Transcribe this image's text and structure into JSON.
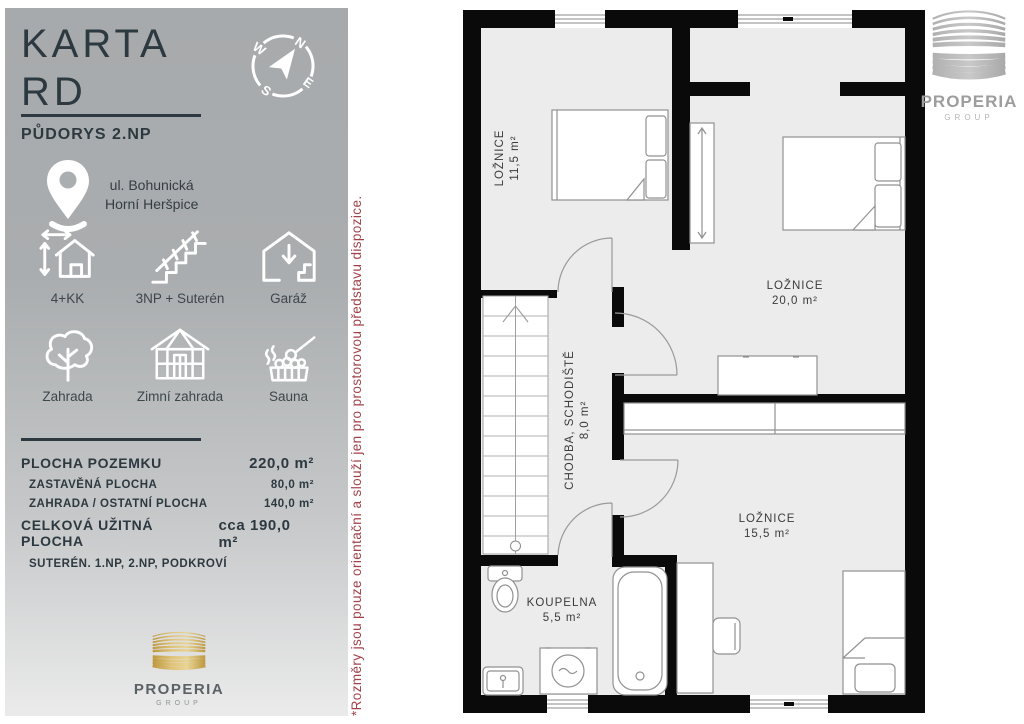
{
  "colors": {
    "accent_red": "#a1424a",
    "gold": "#c9a64e",
    "panel_text": "#2d3940",
    "wall": "#0a0a0a",
    "room_fill": "#ececec"
  },
  "panel": {
    "title_line1": "KARTA",
    "title_line2": "RD",
    "subtitle": "PŮDORYS 2.NP",
    "address_line1": "ul. Bohunická",
    "address_line2": "Horní Heršpice",
    "features": [
      {
        "icon": "house-dimensions-icon",
        "label": "4+KK"
      },
      {
        "icon": "stairs-icon",
        "label": "3NP + Suterén"
      },
      {
        "icon": "garage-icon",
        "label": "Garáž"
      },
      {
        "icon": "tree-icon",
        "label": "Zahrada"
      },
      {
        "icon": "greenhouse-icon",
        "label": "Zimní zahrada"
      },
      {
        "icon": "sauna-icon",
        "label": "Sauna"
      }
    ],
    "areas": [
      {
        "label": "PLOCHA POZEMKU",
        "value": "220,0 m²"
      },
      {
        "label": "ZASTAVĚNÁ PLOCHA",
        "value": "80,0 m²"
      },
      {
        "label": "ZAHRADA / OSTATNÍ PLOCHA",
        "value": "140,0 m²"
      },
      {
        "label": "CELKOVÁ UŽITNÁ PLOCHA",
        "value": "cca 190,0 m²"
      },
      {
        "label": "SUTERÉN. 1.NP, 2.NP, PODKROVÍ",
        "value": ""
      }
    ],
    "logo": {
      "name": "PROPERIA",
      "sub": "GROUP"
    }
  },
  "compass": {
    "n": "N",
    "e": "E",
    "s": "S",
    "w": "W"
  },
  "disclaimer": "*Rozměry jsou pouze orientační a slouží jen pro prostorovou představu dispozice.",
  "plan": {
    "logo": {
      "name": "PROPERIA",
      "sub": "GROUP"
    },
    "rooms": [
      {
        "name": "LOŽNICE",
        "area": "11,5 m²"
      },
      {
        "name": "LOŽNICE",
        "area": "20,0 m²"
      },
      {
        "name": "CHODBA, SCHODIŠTĚ",
        "area": "8,0 m²"
      },
      {
        "name": "LOŽNICE",
        "area": "15,5 m²"
      },
      {
        "name": "KOUPELNA",
        "area": "5,5 m²"
      }
    ]
  }
}
